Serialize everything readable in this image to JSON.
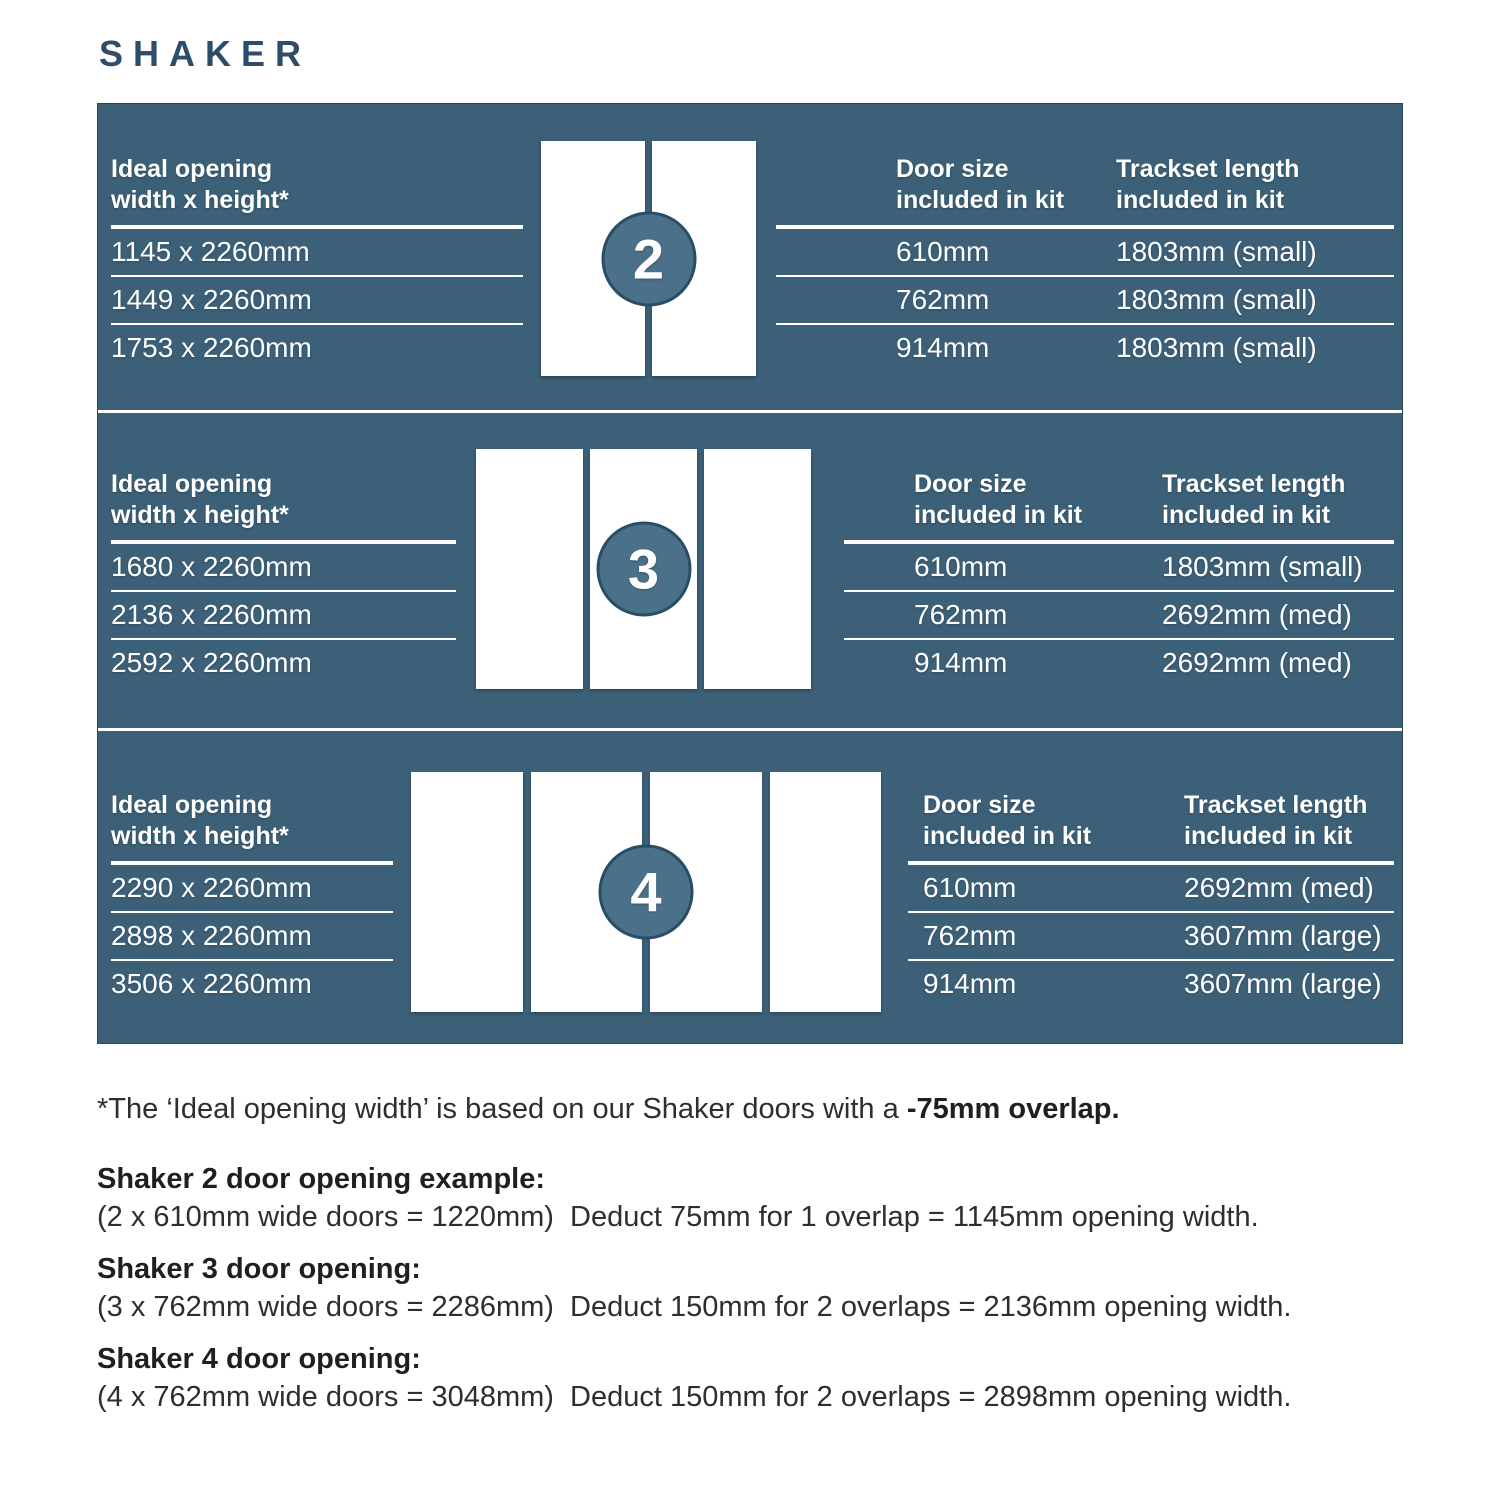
{
  "title": "SHAKER",
  "colors": {
    "panel_background": "#3C6078",
    "badge_fill": "#4B7089",
    "badge_border": "#2A4D66",
    "title_text": "#2D4D68",
    "panel_text": "#FFFFFF",
    "body_text": "#2E2E2E",
    "door_fill": "#FFFFFF"
  },
  "headers": {
    "opening_line1": "Ideal opening",
    "opening_line2": "width x height*",
    "door_size_line1": "Door size",
    "door_size_line2": "included in kit",
    "trackset_line1": "Trackset length",
    "trackset_line2": "included in kit"
  },
  "sections": [
    {
      "badge": "2",
      "door_count": 2,
      "openings": [
        "1145 x 2260mm",
        "1449 x 2260mm",
        "1753 x 2260mm"
      ],
      "door_sizes": [
        "610mm",
        "762mm",
        "914mm"
      ],
      "tracksets": [
        "1803mm (small)",
        "1803mm (small)",
        "1803mm (small)"
      ]
    },
    {
      "badge": "3",
      "door_count": 3,
      "openings": [
        "1680 x 2260mm",
        "2136 x 2260mm",
        "2592 x 2260mm"
      ],
      "door_sizes": [
        "610mm",
        "762mm",
        "914mm"
      ],
      "tracksets": [
        "1803mm (small)",
        "2692mm (med)",
        "2692mm (med)"
      ]
    },
    {
      "badge": "4",
      "door_count": 4,
      "openings": [
        "2290 x 2260mm",
        "2898 x 2260mm",
        "3506 x 2260mm"
      ],
      "door_sizes": [
        "610mm",
        "762mm",
        "914mm"
      ],
      "tracksets": [
        "2692mm (med)",
        "3607mm (large)",
        "3607mm (large)"
      ]
    }
  ],
  "footnote": {
    "regular": "*The ‘Ideal opening width’ is based on our Shaker doors with a ",
    "bold": "-75mm overlap."
  },
  "examples": [
    {
      "title": "Shaker 2 door opening example:",
      "body": "(2 x 610mm wide doors = 1220mm)  Deduct 75mm for 1 overlap = 1145mm opening width."
    },
    {
      "title": "Shaker 3 door opening:",
      "body": "(3 x 762mm wide doors = 2286mm)  Deduct 150mm for 2 overlaps = 2136mm opening width."
    },
    {
      "title": "Shaker 4 door opening:",
      "body": "(4 x 762mm wide doors = 3048mm)  Deduct 150mm for 2 overlaps = 2898mm opening width."
    }
  ]
}
